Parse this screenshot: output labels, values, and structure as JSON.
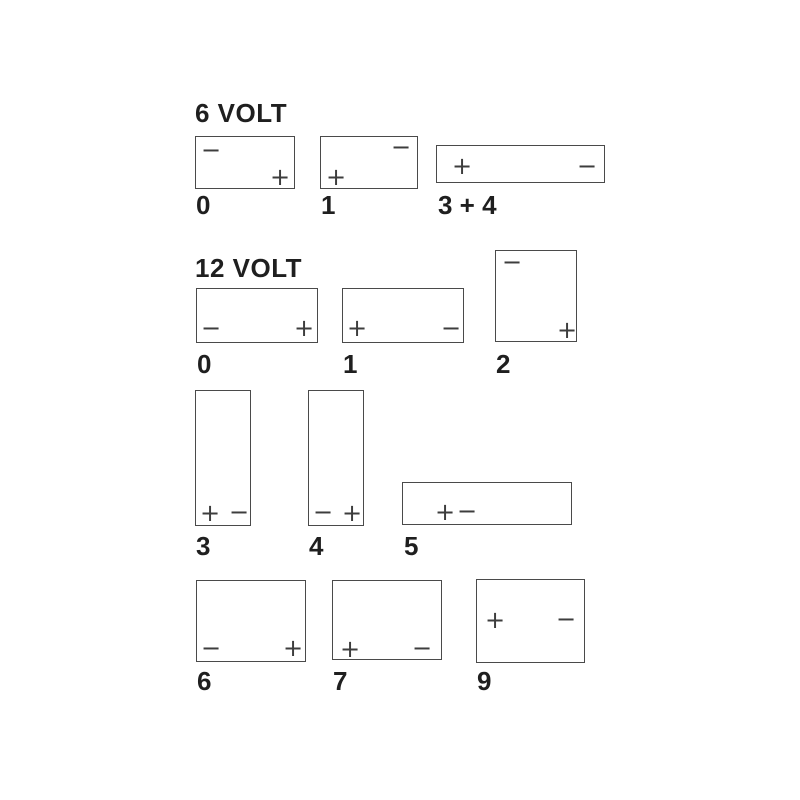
{
  "styles": {
    "background": "#ffffff",
    "box_border_color": "#4a4a4a",
    "text_color": "#1f1f1f",
    "terminal_color": "#3d3d3d"
  },
  "diagram": {
    "sections": [
      {
        "heading": "6 VOLT",
        "heading_pos": {
          "left": 195,
          "top": 100
        },
        "batteries": [
          {
            "label": "0",
            "label_pos": {
              "left": 196,
              "top": 192
            },
            "box": {
              "left": 195,
              "top": 136,
              "width": 100,
              "height": 53
            },
            "terminals": [
              {
                "polarity": "negative",
                "symbol": "−",
                "cx": 15,
                "cy": 13
              },
              {
                "polarity": "positive",
                "symbol": "+",
                "cx": 84,
                "cy": 40
              }
            ]
          },
          {
            "label": "1",
            "label_pos": {
              "left": 321,
              "top": 192
            },
            "box": {
              "left": 320,
              "top": 136,
              "width": 98,
              "height": 53
            },
            "terminals": [
              {
                "polarity": "negative",
                "symbol": "−",
                "cx": 80,
                "cy": 10
              },
              {
                "polarity": "positive",
                "symbol": "+",
                "cx": 15,
                "cy": 40
              }
            ]
          },
          {
            "label": "3 + 4",
            "label_pos": {
              "left": 438,
              "top": 192
            },
            "box": {
              "left": 436,
              "top": 145,
              "width": 169,
              "height": 38
            },
            "terminals": [
              {
                "polarity": "positive",
                "symbol": "+",
                "cx": 25,
                "cy": 20
              },
              {
                "polarity": "negative",
                "symbol": "−",
                "cx": 150,
                "cy": 20
              }
            ]
          }
        ]
      },
      {
        "heading": "12 VOLT",
        "heading_pos": {
          "left": 195,
          "top": 255
        },
        "batteries": [
          {
            "label": "0",
            "label_pos": {
              "left": 197,
              "top": 351
            },
            "box": {
              "left": 196,
              "top": 288,
              "width": 122,
              "height": 55
            },
            "terminals": [
              {
                "polarity": "negative",
                "symbol": "−",
                "cx": 14,
                "cy": 39
              },
              {
                "polarity": "positive",
                "symbol": "+",
                "cx": 107,
                "cy": 39
              }
            ]
          },
          {
            "label": "1",
            "label_pos": {
              "left": 343,
              "top": 351
            },
            "box": {
              "left": 342,
              "top": 288,
              "width": 122,
              "height": 55
            },
            "terminals": [
              {
                "polarity": "positive",
                "symbol": "+",
                "cx": 14,
                "cy": 39
              },
              {
                "polarity": "negative",
                "symbol": "−",
                "cx": 108,
                "cy": 39
              }
            ]
          },
          {
            "label": "2",
            "label_pos": {
              "left": 496,
              "top": 351
            },
            "box": {
              "left": 495,
              "top": 250,
              "width": 82,
              "height": 92
            },
            "terminals": [
              {
                "polarity": "negative",
                "symbol": "−",
                "cx": 16,
                "cy": 11
              },
              {
                "polarity": "positive",
                "symbol": "+",
                "cx": 71,
                "cy": 79
              }
            ]
          },
          {
            "label": "3",
            "label_pos": {
              "left": 196,
              "top": 533
            },
            "box": {
              "left": 195,
              "top": 390,
              "width": 56,
              "height": 136
            },
            "terminals": [
              {
                "polarity": "positive",
                "symbol": "+",
                "cx": 14,
                "cy": 122
              },
              {
                "polarity": "negative",
                "symbol": "−",
                "cx": 43,
                "cy": 121
              }
            ]
          },
          {
            "label": "4",
            "label_pos": {
              "left": 309,
              "top": 533
            },
            "box": {
              "left": 308,
              "top": 390,
              "width": 56,
              "height": 136
            },
            "terminals": [
              {
                "polarity": "negative",
                "symbol": "−",
                "cx": 14,
                "cy": 121
              },
              {
                "polarity": "positive",
                "symbol": "+",
                "cx": 43,
                "cy": 122
              }
            ]
          },
          {
            "label": "5",
            "label_pos": {
              "left": 404,
              "top": 533
            },
            "box": {
              "left": 402,
              "top": 482,
              "width": 170,
              "height": 43
            },
            "terminals": [
              {
                "polarity": "positive",
                "symbol": "+",
                "cx": 42,
                "cy": 29
              },
              {
                "polarity": "negative",
                "symbol": "−",
                "cx": 64,
                "cy": 28
              }
            ]
          },
          {
            "label": "6",
            "label_pos": {
              "left": 197,
              "top": 668
            },
            "box": {
              "left": 196,
              "top": 580,
              "width": 110,
              "height": 82
            },
            "terminals": [
              {
                "polarity": "negative",
                "symbol": "−",
                "cx": 14,
                "cy": 67
              },
              {
                "polarity": "positive",
                "symbol": "+",
                "cx": 96,
                "cy": 67
              }
            ]
          },
          {
            "label": "7",
            "label_pos": {
              "left": 333,
              "top": 668
            },
            "box": {
              "left": 332,
              "top": 580,
              "width": 110,
              "height": 80
            },
            "terminals": [
              {
                "polarity": "positive",
                "symbol": "+",
                "cx": 17,
                "cy": 68
              },
              {
                "polarity": "negative",
                "symbol": "−",
                "cx": 89,
                "cy": 67
              }
            ]
          },
          {
            "label": "9",
            "label_pos": {
              "left": 477,
              "top": 668
            },
            "box": {
              "left": 476,
              "top": 579,
              "width": 109,
              "height": 84
            },
            "terminals": [
              {
                "polarity": "positive",
                "symbol": "+",
                "cx": 18,
                "cy": 40
              },
              {
                "polarity": "negative",
                "symbol": "−",
                "cx": 89,
                "cy": 39
              }
            ]
          }
        ]
      }
    ]
  }
}
